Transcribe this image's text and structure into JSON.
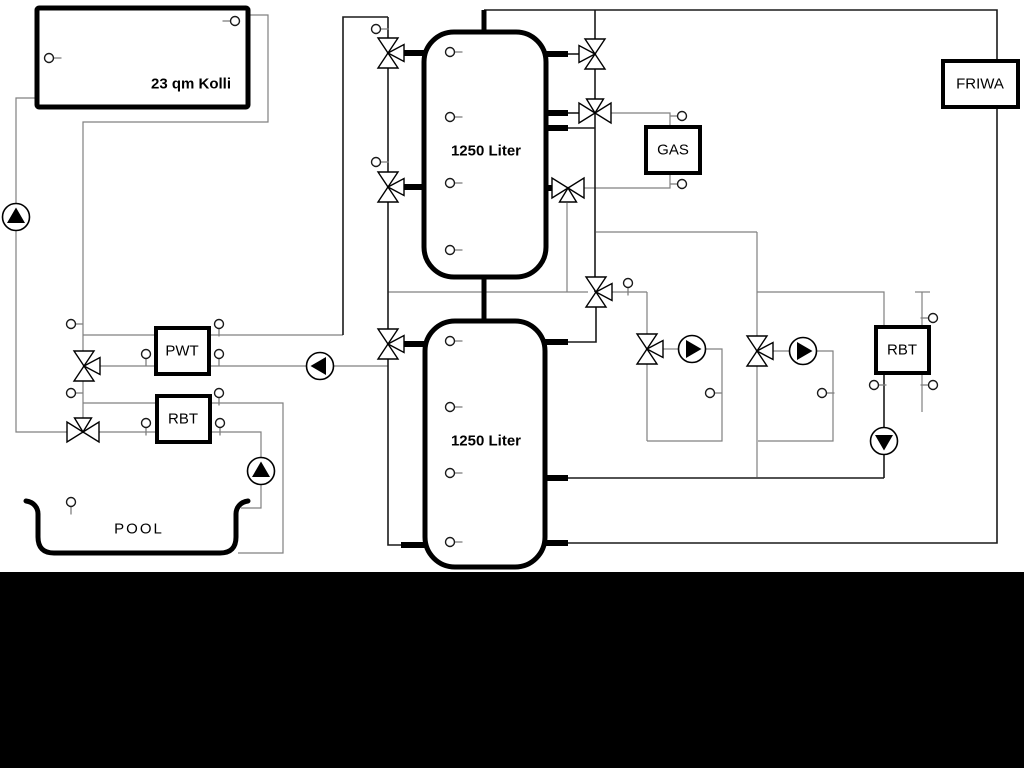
{
  "diagram": {
    "canvas": {
      "w": 1024,
      "h": 768,
      "bg": "#ffffff"
    },
    "colors": {
      "pipe_dark": "#1a1a1a",
      "pipe_gray": "#808080",
      "component_stroke": "#000000",
      "component_fill": "#ffffff",
      "pump_triangle": "#000000",
      "bottom_bar": "#000000"
    },
    "boxes": [
      {
        "id": "collector",
        "label": "23 qm Kolli",
        "x": 37,
        "y": 8,
        "w": 211,
        "h": 99,
        "rx": 2,
        "sw": 5,
        "bold": true,
        "lx": 191,
        "ly": 84
      },
      {
        "id": "tank1",
        "label": "1250 Liter",
        "x": 424,
        "y": 32,
        "w": 122,
        "h": 245,
        "rx": 30,
        "sw": 5,
        "bold": true,
        "lx": 486,
        "ly": 151
      },
      {
        "id": "tank2",
        "label": "1250 Liter",
        "x": 425,
        "y": 321,
        "w": 120,
        "h": 246,
        "rx": 30,
        "sw": 5,
        "bold": true,
        "lx": 486,
        "ly": 441
      },
      {
        "id": "gas-boiler",
        "label": "GAS",
        "x": 646,
        "y": 127,
        "w": 54,
        "h": 46,
        "rx": 0,
        "sw": 4,
        "bold": false,
        "lx": 673,
        "ly": 150
      },
      {
        "id": "friwa",
        "label": "FRIWA",
        "x": 943,
        "y": 61,
        "w": 75,
        "h": 46,
        "rx": 0,
        "sw": 4,
        "bold": false,
        "lx": 980,
        "ly": 84
      },
      {
        "id": "pwt",
        "label": "PWT",
        "x": 156,
        "y": 328,
        "w": 53,
        "h": 46,
        "rx": 0,
        "sw": 4,
        "bold": false,
        "lx": 182,
        "ly": 351
      },
      {
        "id": "rbt-left",
        "label": "RBT",
        "x": 157,
        "y": 396,
        "w": 53,
        "h": 46,
        "rx": 0,
        "sw": 4,
        "bold": false,
        "lx": 183,
        "ly": 419
      },
      {
        "id": "rbt-right",
        "label": "RBT",
        "x": 876,
        "y": 327,
        "w": 53,
        "h": 46,
        "rx": 0,
        "sw": 4,
        "bold": false,
        "lx": 902,
        "ly": 350
      }
    ],
    "pool": {
      "label": "POOL",
      "lx": 139,
      "ly": 529,
      "path": "M 26,501 C 34,502 38,508 38,514 L 38,537 Q 38,553 54,553 L 220,553 Q 236,553 236,537 L 236,514 C 236,508 240,502 248,501"
    },
    "pipes_gray": [
      {
        "pts": [
          [
            37,
            98
          ],
          [
            16,
            98
          ],
          [
            16,
            432
          ],
          [
            67,
            432
          ]
        ]
      },
      {
        "pts": [
          [
            248,
            15
          ],
          [
            268,
            15
          ],
          [
            268,
            122
          ],
          [
            83,
            122
          ],
          [
            83,
            352
          ]
        ]
      },
      {
        "pts": [
          [
            83,
            335
          ],
          [
            156,
            335
          ]
        ]
      },
      {
        "pts": [
          [
            209,
            335
          ],
          [
            343,
            335
          ]
        ]
      },
      {
        "pts": [
          [
            100,
            366
          ],
          [
            156,
            366
          ]
        ]
      },
      {
        "pts": [
          [
            209,
            366
          ],
          [
            307,
            366
          ]
        ]
      },
      {
        "pts": [
          [
            333,
            366
          ],
          [
            388,
            366
          ]
        ]
      },
      {
        "pts": [
          [
            83,
            381
          ],
          [
            83,
            418
          ]
        ]
      },
      {
        "pts": [
          [
            83,
            403
          ],
          [
            157,
            403
          ]
        ]
      },
      {
        "pts": [
          [
            99,
            432
          ],
          [
            157,
            432
          ]
        ]
      },
      {
        "pts": [
          [
            210,
            403
          ],
          [
            283,
            403
          ],
          [
            283,
            553
          ],
          [
            238,
            553
          ]
        ]
      },
      {
        "pts": [
          [
            210,
            432
          ],
          [
            261,
            432
          ],
          [
            261,
            458
          ]
        ]
      },
      {
        "pts": [
          [
            261,
            484
          ],
          [
            261,
            508
          ],
          [
            241,
            508
          ]
        ]
      },
      {
        "pts": [
          [
            388,
            292
          ],
          [
            588,
            292
          ]
        ]
      },
      {
        "pts": [
          [
            612,
            292
          ],
          [
            647,
            292
          ]
        ]
      },
      {
        "pts": [
          [
            567,
            203
          ],
          [
            567,
            292
          ]
        ]
      },
      {
        "pts": [
          [
            611,
            113
          ],
          [
            670,
            113
          ],
          [
            670,
            127
          ]
        ]
      },
      {
        "pts": [
          [
            584,
            188
          ],
          [
            670,
            188
          ],
          [
            670,
            173
          ]
        ]
      },
      {
        "pts": [
          [
            596,
            232
          ],
          [
            757,
            232
          ]
        ]
      },
      {
        "pts": [
          [
            757,
            232
          ],
          [
            757,
            477
          ]
        ]
      },
      {
        "pts": [
          [
            757,
            292
          ],
          [
            884,
            292
          ],
          [
            884,
            327
          ]
        ]
      },
      {
        "pts": [
          [
            922,
            292
          ],
          [
            922,
            327
          ]
        ]
      },
      {
        "pts": [
          [
            915,
            292
          ],
          [
            930,
            292
          ]
        ]
      },
      {
        "pts": [
          [
            922,
            373
          ],
          [
            922,
            412
          ]
        ]
      },
      {
        "pts": [
          [
            663,
            349
          ],
          [
            679,
            349
          ]
        ]
      },
      {
        "pts": [
          [
            706,
            349
          ],
          [
            722,
            349
          ],
          [
            722,
            441
          ],
          [
            647,
            441
          ]
        ]
      },
      {
        "pts": [
          [
            647,
            292
          ],
          [
            647,
            441
          ]
        ]
      },
      {
        "pts": [
          [
            773,
            351
          ],
          [
            790,
            351
          ]
        ]
      },
      {
        "pts": [
          [
            816,
            351
          ],
          [
            833,
            351
          ],
          [
            833,
            441
          ],
          [
            758,
            441
          ]
        ]
      }
    ],
    "pipes_dark": [
      {
        "pts": [
          [
            484,
            10
          ],
          [
            997,
            10
          ],
          [
            997,
            543
          ],
          [
            567,
            543
          ]
        ]
      },
      {
        "pts": [
          [
            884,
            478
          ],
          [
            567,
            478
          ]
        ]
      },
      {
        "pts": [
          [
            595,
            10
          ],
          [
            595,
            292
          ]
        ]
      },
      {
        "pts": [
          [
            596,
            292
          ],
          [
            596,
            342
          ],
          [
            567,
            342
          ]
        ]
      },
      {
        "pts": [
          [
            388,
            17
          ],
          [
            388,
            545
          ],
          [
            402,
            545
          ]
        ]
      },
      {
        "pts": [
          [
            343,
            335
          ],
          [
            343,
            17
          ],
          [
            388,
            17
          ]
        ]
      },
      {
        "pts": [
          [
            567,
            54
          ],
          [
            581,
            54
          ]
        ]
      },
      {
        "pts": [
          [
            567,
            113
          ],
          [
            580,
            113
          ]
        ]
      },
      {
        "pts": [
          [
            567,
            128
          ],
          [
            595,
            128
          ]
        ]
      },
      {
        "pts": [
          [
            884,
            373
          ],
          [
            884,
            478
          ]
        ]
      }
    ],
    "pipes_thick": [
      {
        "pts": [
          [
            484,
            10
          ],
          [
            484,
            33
          ]
        ],
        "sw": 5
      },
      {
        "pts": [
          [
            484,
            276
          ],
          [
            484,
            322
          ]
        ],
        "sw": 5
      },
      {
        "pts": [
          [
            401,
            53
          ],
          [
            426,
            53
          ]
        ],
        "sw": 6
      },
      {
        "pts": [
          [
            401,
            187
          ],
          [
            426,
            187
          ]
        ],
        "sw": 6
      },
      {
        "pts": [
          [
            544,
            54
          ],
          [
            568,
            54
          ]
        ],
        "sw": 6
      },
      {
        "pts": [
          [
            544,
            113
          ],
          [
            568,
            113
          ]
        ],
        "sw": 6
      },
      {
        "pts": [
          [
            544,
            128
          ],
          [
            568,
            128
          ]
        ],
        "sw": 6
      },
      {
        "pts": [
          [
            544,
            188
          ],
          [
            557,
            188
          ]
        ],
        "sw": 6
      },
      {
        "pts": [
          [
            401,
            344
          ],
          [
            426,
            344
          ]
        ],
        "sw": 6
      },
      {
        "pts": [
          [
            401,
            545
          ],
          [
            426,
            545
          ]
        ],
        "sw": 6
      },
      {
        "pts": [
          [
            544,
            342
          ],
          [
            568,
            342
          ]
        ],
        "sw": 6
      },
      {
        "pts": [
          [
            544,
            478
          ],
          [
            568,
            478
          ]
        ],
        "sw": 6
      },
      {
        "pts": [
          [
            544,
            543
          ],
          [
            568,
            543
          ]
        ],
        "sw": 6
      }
    ],
    "valves": [
      {
        "x": 388,
        "y": 53,
        "t": "vR"
      },
      {
        "x": 388,
        "y": 187,
        "t": "vR"
      },
      {
        "x": 388,
        "y": 344,
        "t": "vR"
      },
      {
        "x": 595,
        "y": 54,
        "t": "vL"
      },
      {
        "x": 595,
        "y": 113,
        "t": "hT"
      },
      {
        "x": 568,
        "y": 188,
        "t": "hB"
      },
      {
        "x": 596,
        "y": 292,
        "t": "vR"
      },
      {
        "x": 647,
        "y": 349,
        "t": "vR"
      },
      {
        "x": 757,
        "y": 351,
        "t": "vR"
      },
      {
        "x": 84,
        "y": 366,
        "t": "vR"
      },
      {
        "x": 83,
        "y": 432,
        "t": "hT"
      }
    ],
    "pumps": [
      {
        "x": 16,
        "y": 217,
        "dir": "up"
      },
      {
        "x": 320,
        "y": 366,
        "dir": "left"
      },
      {
        "x": 261,
        "y": 471,
        "dir": "up"
      },
      {
        "x": 692,
        "y": 349,
        "dir": "right"
      },
      {
        "x": 803,
        "y": 351,
        "dir": "right"
      },
      {
        "x": 884,
        "y": 441,
        "dir": "down"
      }
    ],
    "sensors": [
      {
        "x": 49,
        "y": 58,
        "stub": "right"
      },
      {
        "x": 235,
        "y": 21,
        "stub": "left"
      },
      {
        "x": 376,
        "y": 29,
        "stub": "right"
      },
      {
        "x": 376,
        "y": 162,
        "stub": "right"
      },
      {
        "x": 71,
        "y": 324,
        "stub": "right"
      },
      {
        "x": 71,
        "y": 393,
        "stub": "right"
      },
      {
        "x": 146,
        "y": 354,
        "stub": "down"
      },
      {
        "x": 146,
        "y": 423,
        "stub": "down"
      },
      {
        "x": 219,
        "y": 324,
        "stub": "down"
      },
      {
        "x": 219,
        "y": 354,
        "stub": "down"
      },
      {
        "x": 219,
        "y": 393,
        "stub": "down"
      },
      {
        "x": 220,
        "y": 423,
        "stub": "down"
      },
      {
        "x": 71,
        "y": 502,
        "stub": "down"
      },
      {
        "x": 450,
        "y": 52,
        "stub": "right"
      },
      {
        "x": 450,
        "y": 117,
        "stub": "right"
      },
      {
        "x": 450,
        "y": 183,
        "stub": "right"
      },
      {
        "x": 450,
        "y": 250,
        "stub": "right"
      },
      {
        "x": 450,
        "y": 341,
        "stub": "right"
      },
      {
        "x": 450,
        "y": 407,
        "stub": "right"
      },
      {
        "x": 450,
        "y": 473,
        "stub": "right"
      },
      {
        "x": 450,
        "y": 542,
        "stub": "right"
      },
      {
        "x": 628,
        "y": 283,
        "stub": "down"
      },
      {
        "x": 682,
        "y": 116,
        "stub": "left"
      },
      {
        "x": 682,
        "y": 184,
        "stub": "left"
      },
      {
        "x": 710,
        "y": 393,
        "stub": "right"
      },
      {
        "x": 822,
        "y": 393,
        "stub": "right"
      },
      {
        "x": 933,
        "y": 318,
        "stub": "left"
      },
      {
        "x": 933,
        "y": 385,
        "stub": "left"
      },
      {
        "x": 874,
        "y": 385,
        "stub": "right"
      }
    ],
    "bottom_bar": {
      "x": 0,
      "y": 572,
      "w": 1024,
      "h": 196
    }
  }
}
